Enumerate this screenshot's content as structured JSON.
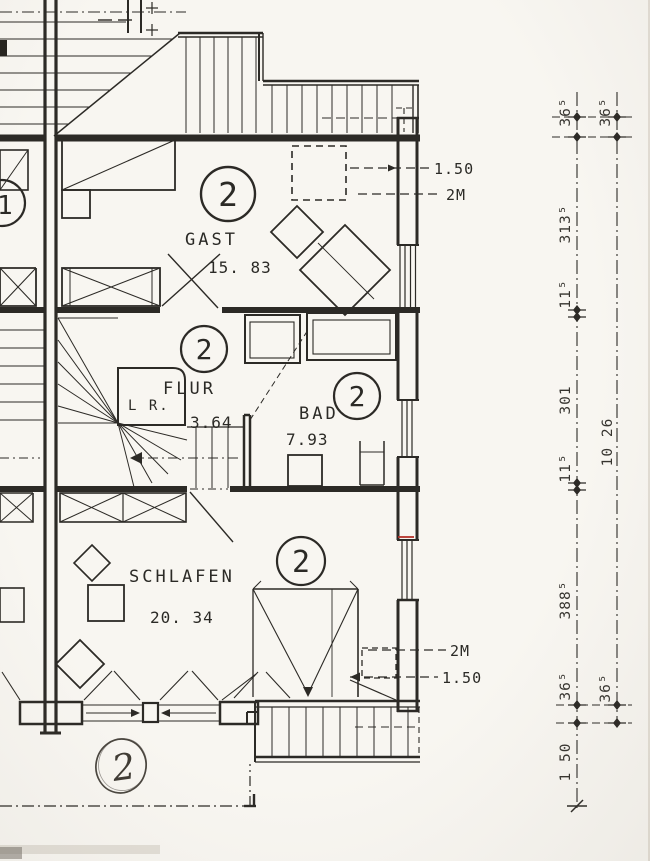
{
  "rooms": {
    "gast": {
      "number": "2",
      "name": "GAST",
      "area": "15. 83"
    },
    "flur": {
      "number": "2",
      "name": "FLUR",
      "area": "3.64"
    },
    "bad": {
      "number": "2",
      "name": "BAD",
      "area": "7.93"
    },
    "schlafen": {
      "number": "2",
      "name": "SCHLAFEN",
      "area": "20. 34"
    }
  },
  "labels": {
    "void_label": "L R.",
    "adjacent_unit_number": "1",
    "sketched_unit_number": "2"
  },
  "height_lines": {
    "top": {
      "line150": "1.50",
      "line2m": "2M"
    },
    "bottom": {
      "line2m": "2M",
      "line150": "1.50"
    }
  },
  "dimensions": {
    "left_chain": [
      "36⁵",
      "313⁵",
      "11⁵",
      "301",
      "11⁵",
      "388⁵",
      "36⁵",
      "1 50"
    ],
    "right_chain": [
      "36⁵",
      "10 26",
      "36⁵"
    ]
  },
  "colors": {
    "ink": "#2c2a26",
    "paper": "#f8f6f1",
    "red_mark": "#b5322a"
  }
}
